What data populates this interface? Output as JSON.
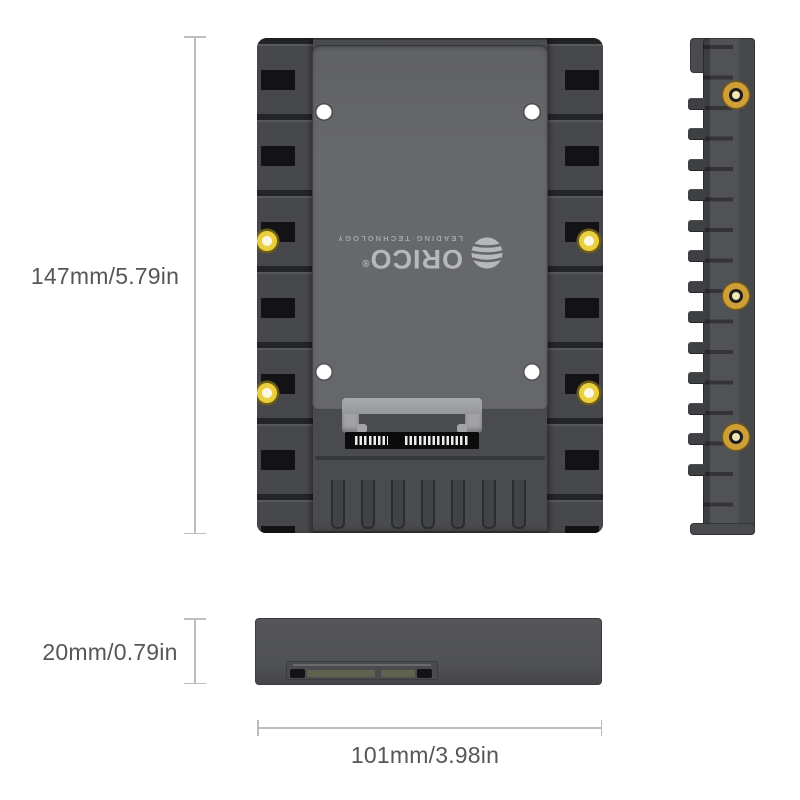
{
  "dimensions": {
    "height": "147mm/5.79in",
    "thickness": "20mm/0.79in",
    "width": "101mm/3.98in"
  },
  "branding": {
    "name": "ORICO",
    "registered_mark": "®",
    "tagline": "LEADING·TECHNOLOGY",
    "logo_icon": "globe-icon",
    "logo_orientation": "rotated-180"
  },
  "colors": {
    "background": "#ffffff",
    "bracket_body": "#4a4b4e",
    "bracket_panel": "#67686c",
    "rail_slot_black": "#131315",
    "screw_hole_gold": "#e9cf3e",
    "screw_hole_gold_side": "#cf9f37",
    "screw_hole_white": "#ffffff",
    "sata_connector_gray": "#a2a3a5",
    "pin_strip_black": "#0b0b0c",
    "connector_contact_olive": "#606250",
    "dimension_line": "#bcbdbf",
    "dimension_text": "#555659"
  }
}
